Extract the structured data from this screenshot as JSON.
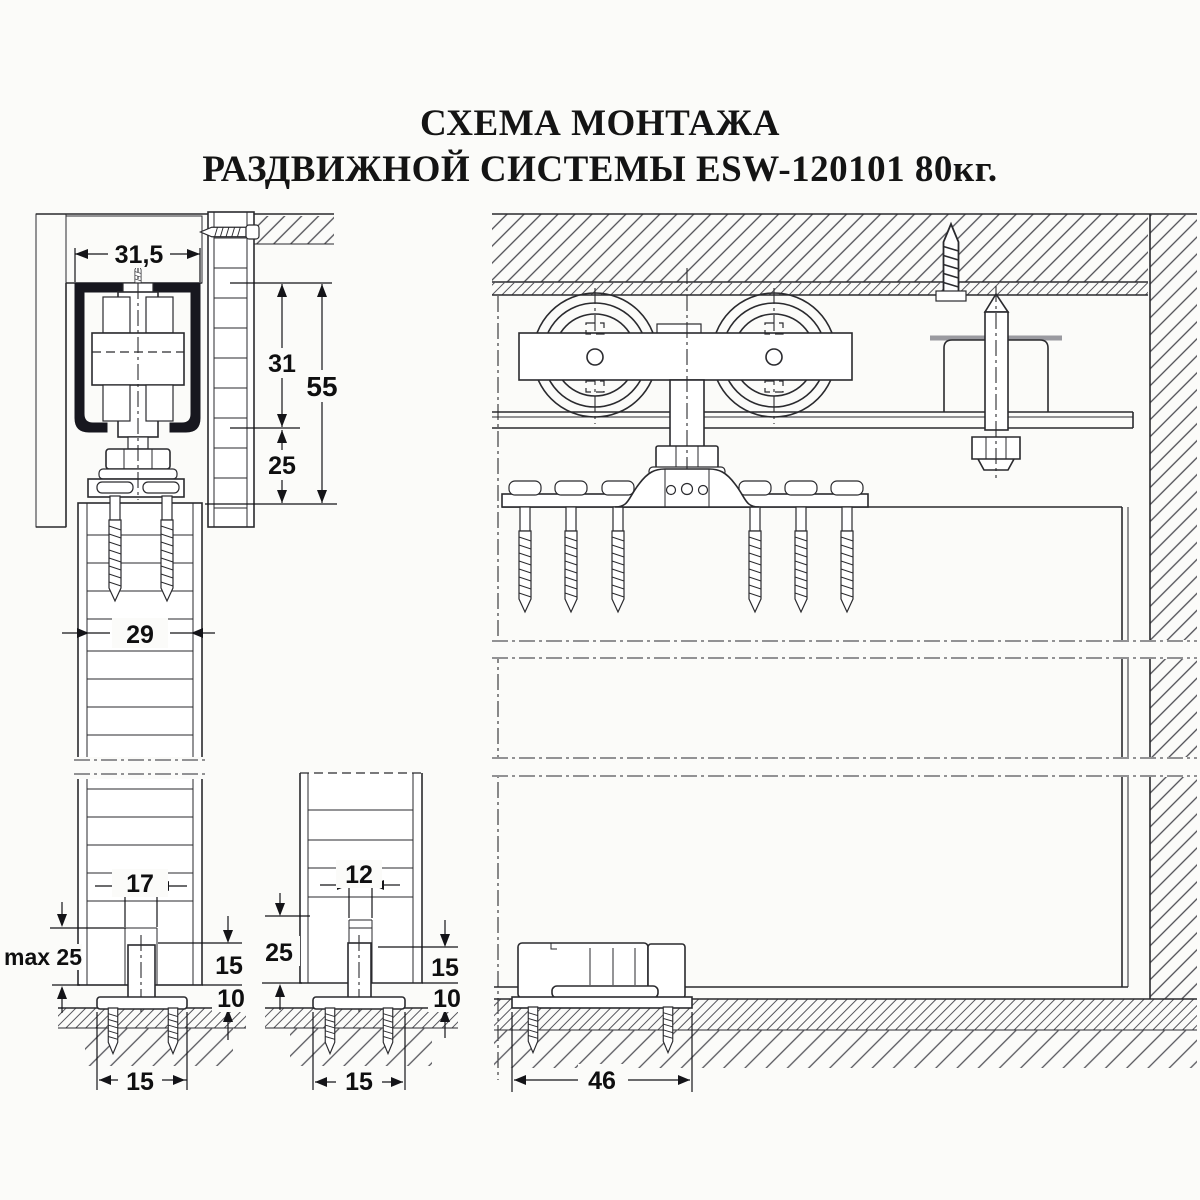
{
  "title": {
    "line1": "СХЕМА МОНТАЖА",
    "line2": "РАЗДВИЖНОЙ СИСТЕМЫ ESW-120101 80кг."
  },
  "dims": {
    "track_width": "31,5",
    "roller_height": "31",
    "overall_height": "55",
    "clearance_below_track": "25",
    "door_thickness": "29",
    "groove_width_chipboard": "17",
    "max_engagement": "max 25",
    "pin_height_chipboard": "15",
    "base_height_chipboard": "10",
    "base_width_chipboard": "15",
    "groove_width_frame": "12",
    "engagement_frame": "25",
    "pin_height_frame": "15",
    "base_height_frame": "10",
    "base_width_frame": "15",
    "floor_guide_length": "46"
  },
  "colors": {
    "line": "#2a2a2e",
    "track_fill": "#17171f",
    "paper": "#fbfbf9",
    "hatch": "#4c4c52"
  }
}
